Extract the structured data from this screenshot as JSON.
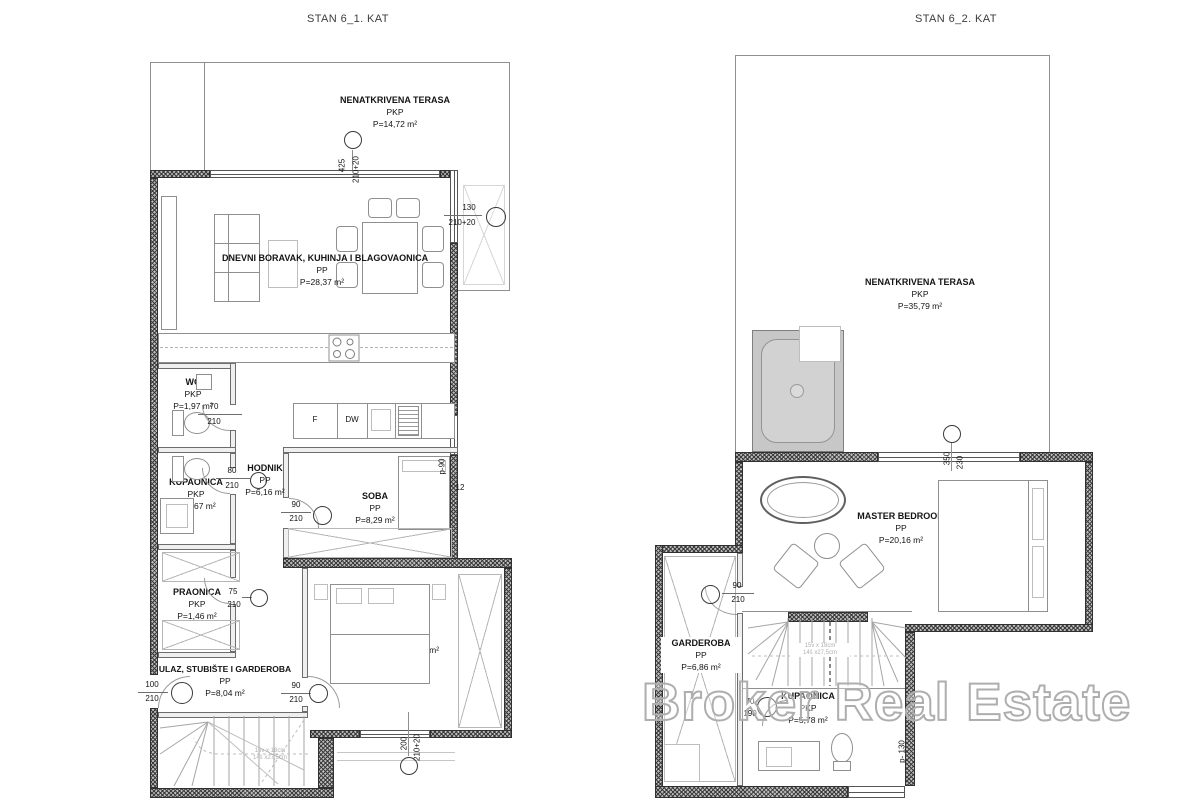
{
  "watermark": "Broker Real Estate",
  "left": {
    "title": "STAN 6_1. KAT",
    "rooms": {
      "terrace": {
        "name": "NENATKRIVENA TERASA",
        "type": "PKP",
        "area": "P=14,72 m²"
      },
      "living": {
        "name": "DNEVNI BORAVAK, KUHINJA I BLAGOVAONICA",
        "type": "PP",
        "area": "P=28,37 m²"
      },
      "wc": {
        "name": "WC",
        "type": "PKP",
        "area": "P=1,97 m²"
      },
      "bathroom": {
        "name": "KUPAONICA",
        "type": "PKP",
        "area": "P=3,67 m²"
      },
      "hallway": {
        "name": "HODNIK",
        "type": "PP",
        "area": "P=6,16 m²"
      },
      "room1": {
        "name": "SOBA",
        "type": "PP",
        "area": "P=8,29 m²"
      },
      "laundry": {
        "name": "PRAONICA",
        "type": "PKP",
        "area": "P=1,46 m²"
      },
      "room2": {
        "name": "SOBA",
        "type": "PP",
        "area": "P=12,16 m²"
      },
      "entry": {
        "name": "ULAZ, STUBIŠTE I GARDEROBA",
        "type": "PP",
        "area": "P=8,04 m²"
      }
    },
    "kitchen": {
      "fridge": "F",
      "dishwasher": "DW"
    },
    "dims": {
      "terrace_door": {
        "w": "425",
        "h": "210+20"
      },
      "balcony_window": {
        "w": "130",
        "h": "210+20"
      },
      "wc_door": {
        "w": "70",
        "h": "210"
      },
      "bath_door": {
        "w": "80",
        "h": "210"
      },
      "room1_door": {
        "w": "90",
        "h": "210"
      },
      "laundry_door": {
        "w": "75",
        "h": "210"
      },
      "entry_door": {
        "w": "100",
        "h": "210"
      },
      "room2_door": {
        "w": "90",
        "h": "210"
      },
      "room2_window": {
        "w": "200",
        "h": "210+20"
      },
      "parapet": "p-90",
      "sill": "12"
    },
    "stairs": {
      "note1": "15v x 18cm",
      "note2": "14š x27,5cm"
    }
  },
  "right": {
    "title": "STAN 6_2. KAT",
    "rooms": {
      "terrace": {
        "name": "NENATKRIVENA TERASA",
        "type": "PKP",
        "area": "P=35,79 m²"
      },
      "master": {
        "name": "MASTER BEDROOM",
        "type": "PP",
        "area": "P=20,16 m²"
      },
      "wardrobe": {
        "name": "GARDEROBA",
        "type": "PP",
        "area": "P=6,86 m²"
      },
      "bathroom": {
        "name": "KUPAONICA",
        "type": "PKP",
        "area": "P=5,78 m²"
      }
    },
    "dims": {
      "terrace_window": {
        "w": "350",
        "h": "230"
      },
      "wardrobe_door": {
        "w": "90",
        "h": "210"
      },
      "bath_door": {
        "w": "70",
        "h": "190"
      },
      "parapet": "p- 130"
    },
    "stairs": {
      "note1": "15v x 18cm",
      "note2": "14š x27,5cm"
    }
  }
}
